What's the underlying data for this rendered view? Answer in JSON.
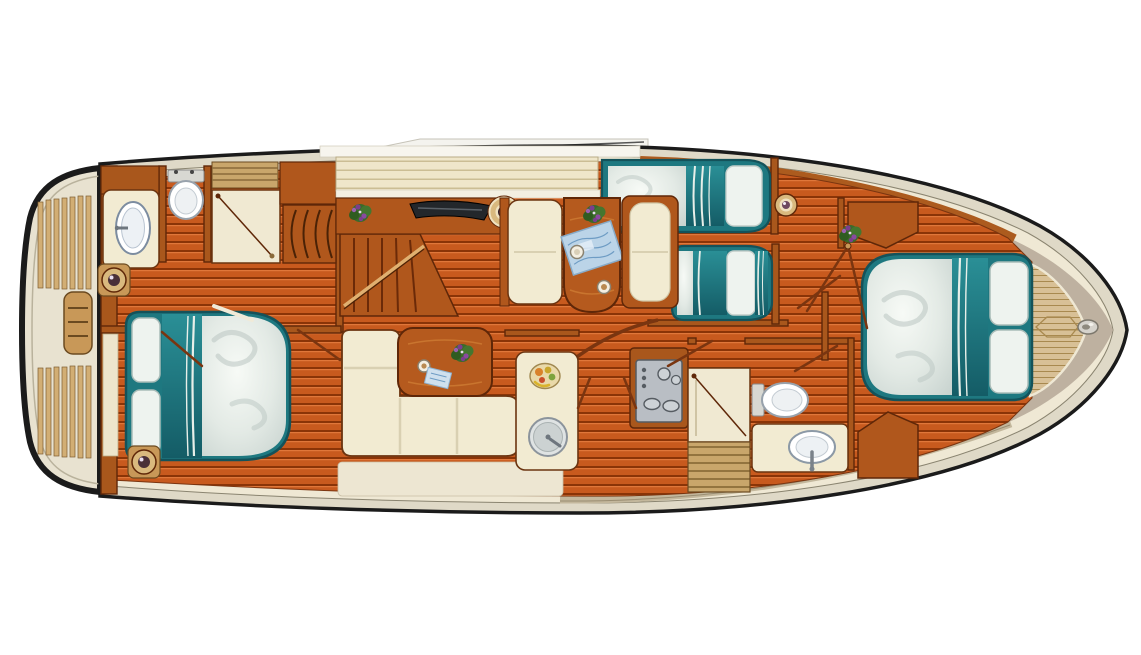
{
  "scene": "motor-yacht-interior-floor-plan-top-view",
  "orientation": {
    "bow": "right",
    "stern": "left"
  },
  "colors": {
    "hull_outline": "#1b1b1b",
    "gunwale": "#dfd9c7",
    "deck_cream": "#efe8d4",
    "bow_cap_tan": "#beb1a0",
    "side_deck_grey": "#c3b79c",
    "floor_plank": "#c85a1e",
    "floor_gap": "#8a3407",
    "floor_highlight": "#e0773a",
    "wall_wood": "#a9571c",
    "wall_edge": "#5f2708",
    "furniture_cream": "#f2ebd2",
    "table_wood": "#b55a1e",
    "bedding_teal": "#1e7880",
    "bedding_teal_deep": "#145c66",
    "duvet_white": "#eef3ef",
    "teak_deck": "#d8c096",
    "teak_slat": "#d9b87f",
    "teak_line": "#a8894f",
    "stove_grey": "#b9bec4",
    "fixture_white": "#ffffff",
    "chart_blue": "#bbd4e8",
    "flower_green": "#3a6b2a",
    "flower_purple": "#7b3e8f",
    "porthole_brass": "#d9b97e",
    "anchor_steel": "#d6d3cc"
  },
  "exterior": {
    "swim_platform": {
      "items": [
        "rubber-fender",
        "teak-slat-deck-upper",
        "teak-slat-deck-lower",
        "boarding-ladder"
      ]
    },
    "windshield": {
      "items": [
        "glass-glint-panel",
        "mullion-line"
      ]
    },
    "bow": {
      "items": [
        "teak-foredeck",
        "deck-hatch",
        "anchor-roller"
      ]
    },
    "side_decks": {
      "items": [
        "top-side-deck",
        "bottom-side-deck-planked"
      ]
    }
  },
  "rooms": [
    {
      "id": "aft-head",
      "label": "aft bathroom",
      "items": [
        "vanity-counter",
        "oval-sink",
        "toilet",
        "shower-cell",
        "hanging-wardrobe",
        "slatted-shelf",
        "storage-cabinet"
      ]
    },
    {
      "id": "aft-cabin",
      "label": "aft cabin",
      "items": [
        "double-bed",
        "two-pillows",
        "teal-blanket-band",
        "duvet",
        "porthole-left",
        "porthole-right",
        "window-shelf"
      ]
    },
    {
      "id": "companionway",
      "label": "stairs",
      "items": [
        "steps",
        "handrail"
      ]
    },
    {
      "id": "helm",
      "label": "helm station",
      "items": [
        "sliding-sunroof",
        "instrument-panel",
        "steering-wheel",
        "flower-pot"
      ]
    },
    {
      "id": "dinette",
      "label": "dinette",
      "items": [
        "bench-left",
        "bench-right",
        "wood-table",
        "sea-chart",
        "cup-1",
        "cup-2",
        "flower-pot"
      ]
    },
    {
      "id": "salon",
      "label": "salon",
      "items": [
        "l-shaped-sofa",
        "coffee-table",
        "flower-pot",
        "cup",
        "magazine"
      ]
    },
    {
      "id": "galley",
      "label": "galley",
      "items": [
        "counter",
        "fruit-bowl",
        "round-sink",
        "stove-with-burners"
      ]
    },
    {
      "id": "guest-cabin",
      "label": "guest cabin",
      "items": [
        "single-bed-upper",
        "single-bed-lower",
        "reading-lamp",
        "doorway"
      ]
    },
    {
      "id": "day-head",
      "label": "lower bathroom",
      "items": [
        "shower-cell",
        "teak-grate",
        "toilet",
        "vanity-counter",
        "oval-sink"
      ]
    },
    {
      "id": "forward-cabin",
      "label": "forward cabin",
      "items": [
        "island-double-bed",
        "two-pillows",
        "dresser-top",
        "dresser-bottom",
        "flower-pot",
        "doorway"
      ]
    }
  ]
}
